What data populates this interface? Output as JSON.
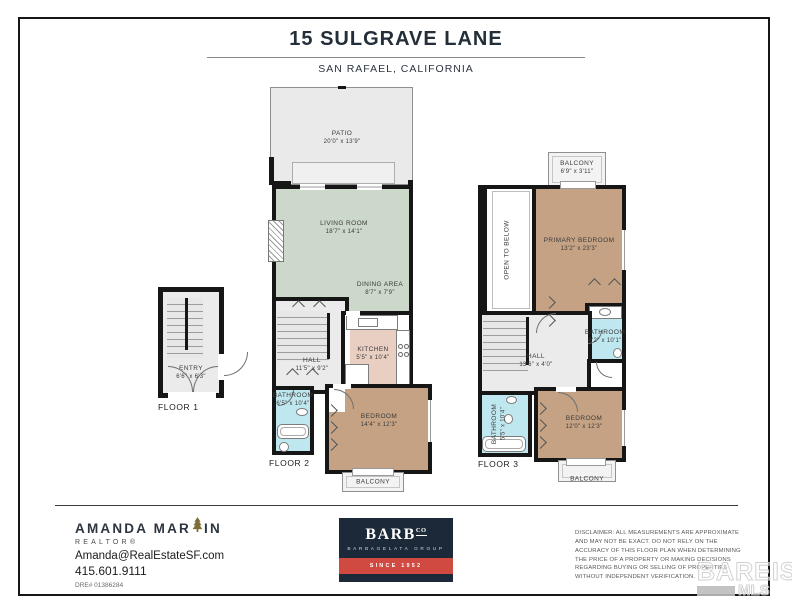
{
  "page": {
    "title": "15 SULGRAVE LANE",
    "subtitle": "SAN RAFAEL, CALIFORNIA"
  },
  "floor1": {
    "label": "FLOOR 1",
    "entry_name": "ENTRY",
    "entry_dims": "6'6\" x 6'3\""
  },
  "floor2": {
    "label": "FLOOR 2",
    "patio_name": "PATIO",
    "patio_dims": "20'0\" x 13'9\"",
    "living_name": "LIVING ROOM",
    "living_dims": "18'7\" x 14'1\"",
    "dining_name": "DINING AREA",
    "dining_dims": "8'7\" x 7'9\"",
    "hall_name": "HALL",
    "hall_dims": "11'5\" x 9'2\"",
    "kitchen_name": "KITCHEN",
    "kitchen_dims": "5'5\" x 10'4\"",
    "bath_name": "BATHROOM",
    "bath_dims": "6'5\" x 10'4\"",
    "bedroom_name": "BEDROOM",
    "bedroom_dims": "14'4\" x 12'3\"",
    "balcony_name": "BALCONY"
  },
  "floor3": {
    "label": "FLOOR 3",
    "balcony_top_name": "BALCONY",
    "balcony_top_dims": "6'9\" x 3'11\"",
    "open_below": "OPEN TO BELOW",
    "primary_name": "PRIMARY BEDROOM",
    "primary_dims": "13'2\" x 23'3\"",
    "bath1_name": "BATHROOM",
    "bath1_dims": "6'2\" x 10'1\"",
    "hall_name": "HALL",
    "hall_dims": "13'6\" x 4'0\"",
    "bath2_name": "BATHROOM",
    "bath2_dims": "5'5\" x 10'4\"",
    "bedroom_name": "BEDROOM",
    "bedroom_dims": "12'0\" x 12'3\"",
    "balcony_bottom_name": "BALCONY"
  },
  "footer": {
    "agent": {
      "name_pre": "AMANDA MAR",
      "name_post": "IN",
      "role": "REALTOR®",
      "email": "Amanda@RealEstateSF.com",
      "phone": "415.601.9111",
      "dre": "DRE# 01386284"
    },
    "brokerage": {
      "name": "BARB",
      "suffix": "CO",
      "group": "BARBAGELATA GROUP",
      "since": "SINCE 1952"
    },
    "disclaimer": "DISCLAIMER: ALL MEASUREMENTS ARE APPROXIMATE AND MAY NOT BE EXACT. DO NOT RELY ON THE ACCURACY OF THIS FLOOR PLAN WHEN DETERMINING THE PRICE OF A PROPERTY OR MAKING DECISIONS REGARDING BUYING OR SELLING OF PROPERTIES WITHOUT INDEPENDENT VERIFICATION.",
    "watermark": {
      "name": "BAREIS",
      "reg": "®",
      "sub": "MLS"
    }
  },
  "colors": {
    "wall": "#161616",
    "living_green": "#ccd8c9",
    "bedroom_tan": "#c5a284",
    "bathroom_cyan": "#bfe7ef",
    "kitchen_pink": "#e9cec2",
    "floor_gray": "#ebebeb",
    "brand_navy": "#1c2938",
    "brand_red": "#d04a41",
    "tree_gold": "#7d6e35"
  }
}
